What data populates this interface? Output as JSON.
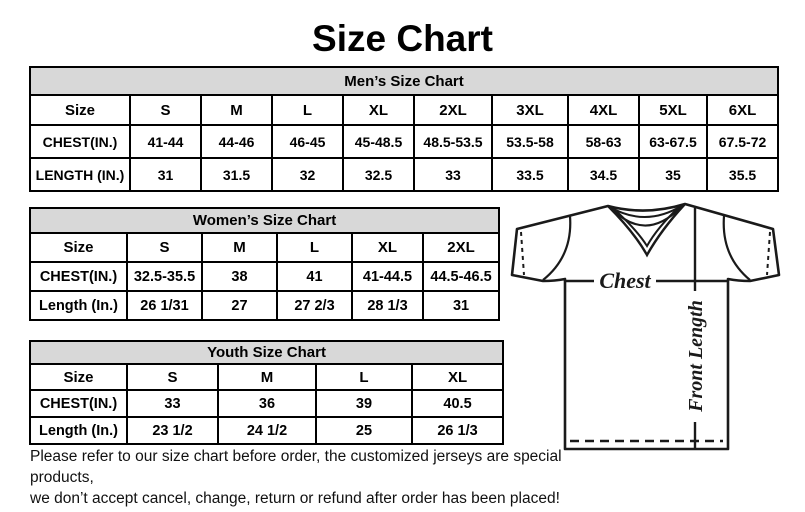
{
  "page": {
    "title": "Size Chart"
  },
  "tables": {
    "men": {
      "title": "Men’s Size Chart",
      "rows": [
        [
          "Size",
          "S",
          "M",
          "L",
          "XL",
          "2XL",
          "3XL",
          "4XL",
          "5XL",
          "6XL"
        ],
        [
          "CHEST(IN.)",
          "41-44",
          "44-46",
          "46-45",
          "45-48.5",
          "48.5-53.5",
          "53.5-58",
          "58-63",
          "63-67.5",
          "67.5-72"
        ],
        [
          "LENGTH (IN.)",
          "31",
          "31.5",
          "32",
          "32.5",
          "33",
          "33.5",
          "34.5",
          "35",
          "35.5"
        ]
      ]
    },
    "women": {
      "title": "Women’s Size Chart",
      "rows": [
        [
          "Size",
          "S",
          "M",
          "L",
          "XL",
          "2XL"
        ],
        [
          "CHEST(IN.)",
          "32.5-35.5",
          "38",
          "41",
          "41-44.5",
          "44.5-46.5"
        ],
        [
          "Length (In.)",
          "26 1/31",
          "27",
          "27 2/3",
          "28 1/3",
          "31"
        ]
      ]
    },
    "youth": {
      "title": "Youth Size Chart",
      "rows": [
        [
          "Size",
          "S",
          "M",
          "L",
          "XL"
        ],
        [
          "CHEST(IN.)",
          "33",
          "36",
          "39",
          "40.5"
        ],
        [
          "Length (In.)",
          "23 1/2",
          "24 1/2",
          "25",
          "26 1/3"
        ]
      ]
    }
  },
  "diagram": {
    "chest_label": "Chest",
    "front_length_label": "Front Length"
  },
  "footer": {
    "line1": "Please refer to our size chart before order, the customized jerseys are special products,",
    "line2": "we don’t accept cancel, change, return or refund after order has been placed!"
  },
  "colors": {
    "header_bg": "#d8d8d8",
    "border": "#000000",
    "text": "#000000"
  }
}
